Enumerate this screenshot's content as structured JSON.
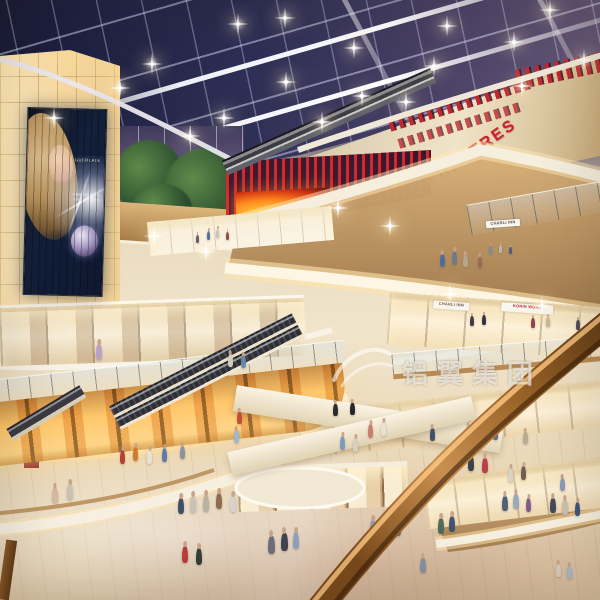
{
  "meta": {
    "description": "Architectural rendering of a multi-level shopping mall atrium at night with glass grid skylight, curved balcony levels, escalators and shoppers",
    "type": "3d-render"
  },
  "signs": {
    "theatre": "THEATRES",
    "store_white": "CHARLI INN",
    "store_red": "KORIN WONG",
    "store_upper": "CHARLI INN",
    "billboard_brand": "GUERLAIN"
  },
  "watermark": {
    "text": "铝翼集团"
  },
  "palette": {
    "ceiling_navy": "#1d1f3e",
    "beam_white": "#eef0f8",
    "wall_glow": "#f7dca6",
    "fascia_cream": "#f4ead4",
    "wood": "#c49a5e",
    "theatre_red": "#c8232e",
    "rail_brown": "#8a5626",
    "floor_beige": "#e9dcc0",
    "screen_fire": "#ff8a1e"
  },
  "ceiling_lights": [
    [
      52,
      116
    ],
    [
      118,
      86
    ],
    [
      150,
      62
    ],
    [
      188,
      134
    ],
    [
      222,
      116
    ],
    [
      236,
      22
    ],
    [
      284,
      80
    ],
    [
      283,
      16
    ],
    [
      352,
      46
    ],
    [
      360,
      94
    ],
    [
      432,
      64
    ],
    [
      445,
      24
    ],
    [
      512,
      40
    ],
    [
      548,
      8
    ],
    [
      520,
      84
    ],
    [
      582,
      58
    ],
    [
      320,
      120
    ],
    [
      404,
      100
    ],
    [
      448,
      292
    ],
    [
      540,
      304
    ],
    [
      204,
      250
    ],
    [
      336,
      206
    ],
    [
      388,
      224
    ],
    [
      152,
      234
    ]
  ],
  "figures": [
    [
      207,
      231,
      9,
      "#4a6a9a"
    ],
    [
      216,
      229,
      9,
      "#c8c4bc"
    ],
    [
      226,
      232,
      8,
      "#8a4a42"
    ],
    [
      196,
      235,
      8,
      "#5a5a6a"
    ],
    [
      489,
      246,
      8,
      "#7a8aa0"
    ],
    [
      499,
      245,
      8,
      "#c0b8a8"
    ],
    [
      509,
      247,
      7,
      "#4a5a7a"
    ],
    [
      440,
      254,
      13,
      "#4a6aa0"
    ],
    [
      452,
      251,
      14,
      "#6a7a94"
    ],
    [
      463,
      255,
      12,
      "#b8a890"
    ],
    [
      478,
      257,
      11,
      "#9a6a5a"
    ],
    [
      96,
      344,
      16,
      "#b9a0c8"
    ],
    [
      228,
      354,
      13,
      "#d8d0c0"
    ],
    [
      241,
      356,
      12,
      "#6a88b0"
    ],
    [
      470,
      316,
      10,
      "#3a3242"
    ],
    [
      482,
      315,
      10,
      "#2e2a38"
    ],
    [
      531,
      318,
      10,
      "#8a3a4a"
    ],
    [
      546,
      317,
      10,
      "#c8b898"
    ],
    [
      576,
      320,
      10,
      "#4a4456"
    ],
    [
      333,
      404,
      12,
      "#23242c"
    ],
    [
      350,
      403,
      12,
      "#1e2026"
    ],
    [
      368,
      424,
      14,
      "#c87a6a"
    ],
    [
      381,
      422,
      14,
      "#e8e2d4"
    ],
    [
      430,
      428,
      13,
      "#384a66"
    ],
    [
      466,
      426,
      13,
      "#d8ccb8"
    ],
    [
      479,
      424,
      13,
      "#7a4a3a"
    ],
    [
      493,
      428,
      12,
      "#5a6a88"
    ],
    [
      523,
      432,
      12,
      "#b8aa92"
    ],
    [
      237,
      412,
      12,
      "#c04838"
    ],
    [
      52,
      488,
      15,
      "#d8b8a0"
    ],
    [
      67,
      484,
      16,
      "#c8c0b4"
    ],
    [
      120,
      450,
      14,
      "#b03a32"
    ],
    [
      133,
      447,
      14,
      "#d07828"
    ],
    [
      147,
      450,
      14,
      "#e8e2d6"
    ],
    [
      162,
      448,
      14,
      "#5a76a8"
    ],
    [
      180,
      446,
      13,
      "#8890a0"
    ],
    [
      234,
      430,
      13,
      "#98b8d8"
    ],
    [
      340,
      436,
      14,
      "#7898c0"
    ],
    [
      353,
      438,
      14,
      "#d8d0c0"
    ],
    [
      468,
      456,
      15,
      "#3a3a44"
    ],
    [
      482,
      458,
      15,
      "#b8384a"
    ],
    [
      508,
      468,
      14,
      "#d8d2c8"
    ],
    [
      521,
      466,
      14,
      "#6a5a4c"
    ],
    [
      560,
      478,
      13,
      "#8898b8"
    ],
    [
      178,
      498,
      16,
      "#3a4a66"
    ],
    [
      190,
      496,
      17,
      "#c8c2b6"
    ],
    [
      203,
      495,
      17,
      "#b8b0a0"
    ],
    [
      216,
      493,
      16,
      "#88684a"
    ],
    [
      230,
      496,
      16,
      "#d8d4cc"
    ],
    [
      268,
      536,
      18,
      "#6a6a78"
    ],
    [
      281,
      533,
      18,
      "#3a3e4c"
    ],
    [
      293,
      532,
      17,
      "#88a0c0"
    ],
    [
      182,
      546,
      17,
      "#b83a36"
    ],
    [
      196,
      548,
      17,
      "#2e3a30"
    ],
    [
      370,
      520,
      16,
      "#8a9ab8"
    ],
    [
      383,
      518,
      16,
      "#e0dcd2"
    ],
    [
      395,
      520,
      16,
      "#4a6a9a"
    ],
    [
      438,
      518,
      16,
      "#486858"
    ],
    [
      449,
      516,
      16,
      "#38506e"
    ],
    [
      502,
      496,
      15,
      "#4a5a78"
    ],
    [
      513,
      494,
      15,
      "#98a8c0"
    ],
    [
      526,
      498,
      14,
      "#7a5a8a"
    ],
    [
      550,
      498,
      15,
      "#3c4458"
    ],
    [
      562,
      500,
      15,
      "#c8c0b0"
    ],
    [
      575,
      502,
      14,
      "#38527e"
    ],
    [
      556,
      564,
      13,
      "#d8ccc0"
    ],
    [
      567,
      566,
      13,
      "#a8b8c8"
    ],
    [
      420,
      558,
      15,
      "#8090a8"
    ]
  ]
}
